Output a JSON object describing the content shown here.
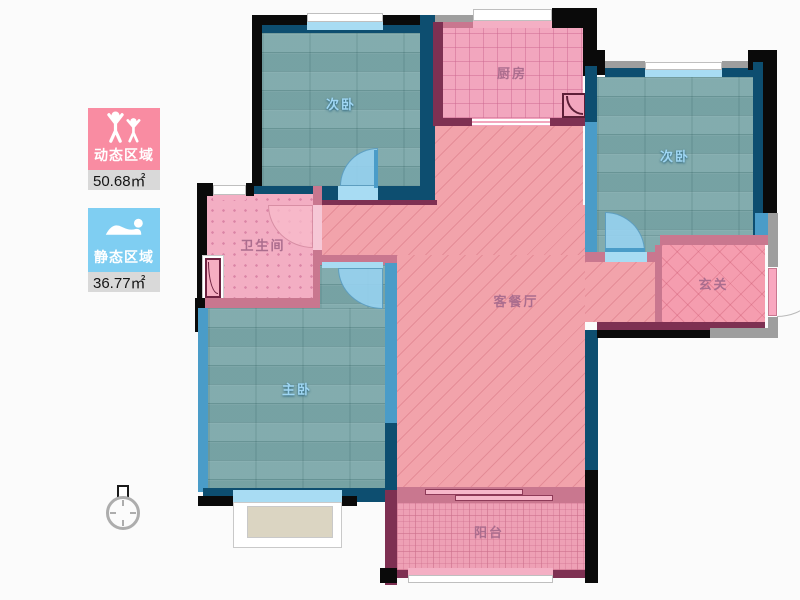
{
  "legend": {
    "dynamic": {
      "label": "动态区域",
      "value": "50.68㎡",
      "color": "#f98ca2"
    },
    "static": {
      "label": "静态区域",
      "value": "36.77㎡",
      "color": "#7fcef2"
    }
  },
  "rooms": {
    "bedroom_a": "次卧",
    "kitchen": "厨房",
    "bedroom_b": "次卧",
    "bathroom": "卫生间",
    "living_dining": "客餐厅",
    "hallway": "玄关",
    "master_bedroom": "主卧",
    "balcony": "阳台"
  },
  "colors": {
    "floor_teal": "#7ca8aa",
    "room_pink": "#f2a6be",
    "wall_navy": "#0d4e70",
    "wall_maroon": "#7e3052",
    "wall_black": "#0a0a0a",
    "window_blue": "#a8dcf3"
  }
}
